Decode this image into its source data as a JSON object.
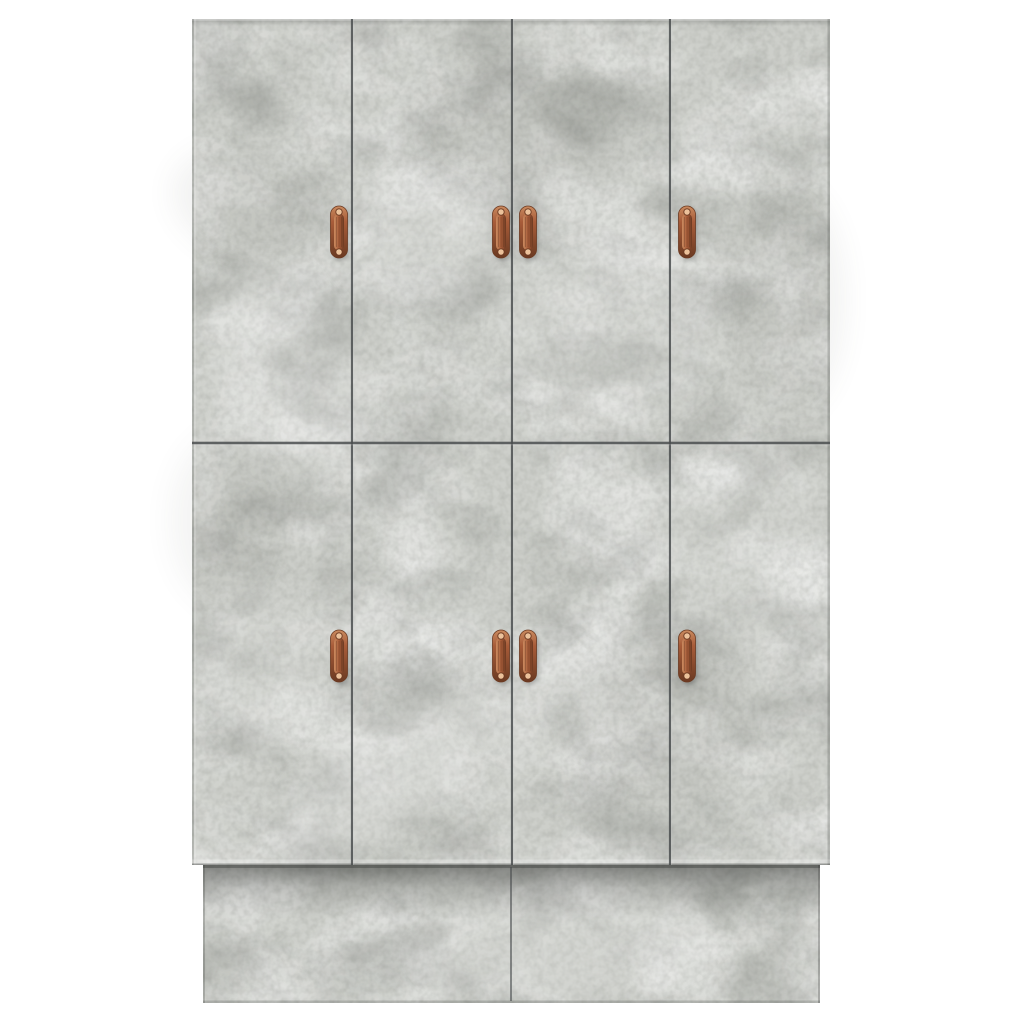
{
  "scene": {
    "width": 1024,
    "height": 1024,
    "background_color": "#ffffff",
    "alt_text": "eight-door wardrobe cabinet, concrete grey finish, copper handles"
  },
  "cabinet": {
    "finish_color_base": "#cdcfca",
    "finish_color_light": "#dcdeda",
    "finish_color_dark": "#b4b6b1",
    "seam_color": "#4a4d4f",
    "shadow_color": "#2e302d",
    "body": {
      "x": 192,
      "y": 19,
      "width": 638,
      "height": 846
    },
    "door_grid": {
      "rows": 2,
      "columns": 4,
      "row_boundaries_y": [
        19,
        443,
        865
      ],
      "column_boundaries_x": [
        192,
        352,
        512,
        670,
        830
      ]
    },
    "plinth": {
      "x": 203,
      "y": 865,
      "width": 617,
      "height": 138,
      "center_seam_x": 511
    },
    "handles": {
      "style": "vertical-copper-strap-handle",
      "color_main": "#a85c39",
      "color_light": "#c98a5f",
      "color_dark": "#6b3a22",
      "screw_color": "#ecc29b",
      "width": 17,
      "height": 52,
      "screw_offset": 20,
      "positions": [
        {
          "door": "top-1",
          "cx": 339,
          "cy": 232
        },
        {
          "door": "top-2",
          "cx": 501,
          "cy": 232
        },
        {
          "door": "top-3",
          "cx": 528,
          "cy": 232
        },
        {
          "door": "top-4",
          "cx": 687,
          "cy": 232
        },
        {
          "door": "bottom-1",
          "cx": 339,
          "cy": 656
        },
        {
          "door": "bottom-2",
          "cx": 501,
          "cy": 656
        },
        {
          "door": "bottom-3",
          "cx": 528,
          "cy": 656
        },
        {
          "door": "bottom-4",
          "cx": 687,
          "cy": 656
        }
      ]
    },
    "texture_patches": [
      {
        "tone": "light",
        "cx": 285,
        "cy": 370,
        "rx": 70,
        "ry": 115,
        "rot": -18,
        "opacity": 0.13
      },
      {
        "tone": "light",
        "cx": 430,
        "cy": 240,
        "rx": 95,
        "ry": 65,
        "rot": -8,
        "opacity": 0.12
      },
      {
        "tone": "light",
        "cx": 385,
        "cy": 775,
        "rx": 125,
        "ry": 50,
        "rot": -33,
        "opacity": 0.18
      },
      {
        "tone": "light",
        "cx": 255,
        "cy": 660,
        "rx": 55,
        "ry": 95,
        "rot": -12,
        "opacity": 0.1
      },
      {
        "tone": "light",
        "cx": 610,
        "cy": 330,
        "rx": 110,
        "ry": 85,
        "rot": 8,
        "opacity": 0.1
      },
      {
        "tone": "light",
        "cx": 565,
        "cy": 945,
        "rx": 150,
        "ry": 55,
        "rot": -4,
        "opacity": 0.13
      },
      {
        "tone": "light",
        "cx": 745,
        "cy": 545,
        "rx": 70,
        "ry": 110,
        "rot": 12,
        "opacity": 0.08
      },
      {
        "tone": "light",
        "cx": 540,
        "cy": 700,
        "rx": 80,
        "ry": 60,
        "rot": 0,
        "opacity": 0.09
      },
      {
        "tone": "dark",
        "cx": 520,
        "cy": 125,
        "rx": 105,
        "ry": 65,
        "rot": 0,
        "opacity": 0.09
      },
      {
        "tone": "dark",
        "cx": 250,
        "cy": 205,
        "rx": 80,
        "ry": 55,
        "rot": 18,
        "opacity": 0.07
      },
      {
        "tone": "dark",
        "cx": 655,
        "cy": 715,
        "rx": 95,
        "ry": 85,
        "rot": 0,
        "opacity": 0.07
      },
      {
        "tone": "dark",
        "cx": 790,
        "cy": 300,
        "rx": 55,
        "ry": 115,
        "rot": 0,
        "opacity": 0.07
      },
      {
        "tone": "dark",
        "cx": 230,
        "cy": 520,
        "rx": 60,
        "ry": 90,
        "rot": 0,
        "opacity": 0.06
      }
    ]
  }
}
